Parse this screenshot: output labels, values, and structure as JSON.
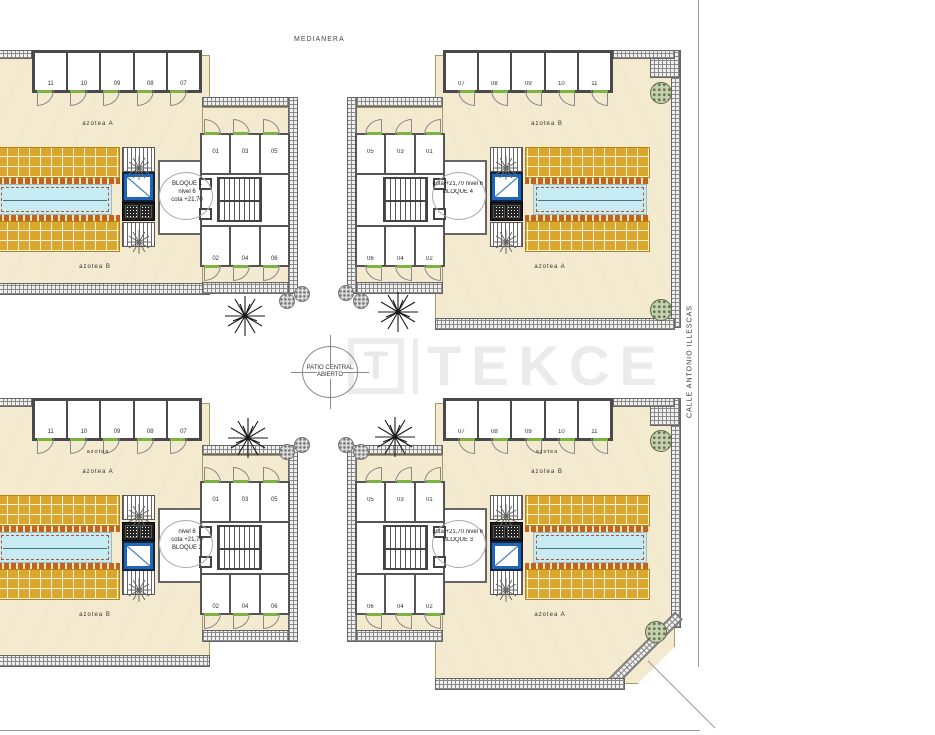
{
  "site": {
    "top_boundary_label": "MEDIANERA",
    "street_label": "CALLE ANTONIO ILLESCAS",
    "patio_circle": {
      "line1": "PATIO CENTRAL",
      "line2": "ABIERTO"
    },
    "watermark": {
      "logo_letter": "T",
      "brand": "TEKCE"
    }
  },
  "palette": {
    "terrace": "#F3EAD0",
    "deck_tile": "#D9A72E",
    "deck_edge": "#C2641E",
    "pool": "#C7EBF2",
    "elevator": "#1E66B8",
    "door_green": "#7CB342"
  },
  "blocks": [
    {
      "name": "BLOQUE 1",
      "position": "top-left",
      "info_lines": [
        "BLOQUE 1",
        "nivel 6",
        "cota +21,70"
      ],
      "storage": [
        "11",
        "10",
        "09",
        "08",
        "07"
      ],
      "rooms_top": [
        "01",
        "03",
        "05"
      ],
      "rooms_bottom": [
        "02",
        "04",
        "06"
      ],
      "label_upper": "azotea A",
      "label_lower": "azotea B",
      "label_small": ""
    },
    {
      "name": "BLOQUE 4",
      "position": "top-right",
      "info_lines": [
        "nivel 6",
        "cota +21,70",
        "BLOQUE 4"
      ],
      "storage": [
        "11",
        "10",
        "09",
        "08",
        "07"
      ],
      "rooms_top": [
        "01",
        "03",
        "05"
      ],
      "rooms_bottom": [
        "02",
        "04",
        "06"
      ],
      "label_upper": "azotea B",
      "label_lower": "azotea A",
      "label_small": ""
    },
    {
      "name": "BLOQUE 2",
      "position": "bottom-left",
      "info_lines": [
        "nivel 6",
        "cota +21,70",
        "BLOQUE 2"
      ],
      "storage": [
        "11",
        "10",
        "09",
        "08",
        "07"
      ],
      "rooms_top": [
        "01",
        "03",
        "05"
      ],
      "rooms_bottom": [
        "02",
        "04",
        "06"
      ],
      "label_upper": "azotea A",
      "label_lower": "azotea B",
      "label_small": "azotea"
    },
    {
      "name": "BLOQUE 3",
      "position": "bottom-right",
      "info_lines": [
        "nivel 6",
        "cota +21,70",
        "BLOQUE 3"
      ],
      "storage": [
        "11",
        "10",
        "09",
        "08",
        "07"
      ],
      "rooms_top": [
        "01",
        "03",
        "05"
      ],
      "rooms_bottom": [
        "02",
        "04",
        "06"
      ],
      "label_upper": "azotea B",
      "label_lower": "azotea A",
      "label_small": "azotea"
    }
  ]
}
